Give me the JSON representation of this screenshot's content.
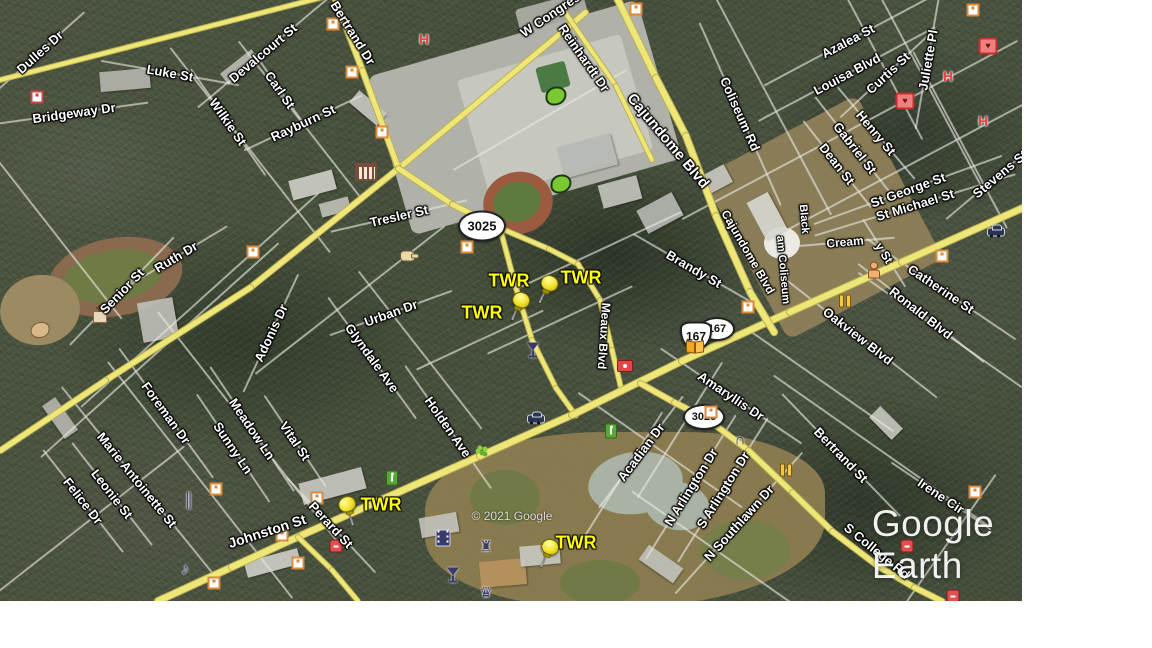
{
  "app": {
    "watermark": "Google Earth",
    "copyright": "© 2021 Google",
    "watermark_pos": {
      "x": 933,
      "y": 545
    },
    "copyright_pos": {
      "x": 512,
      "y": 516
    }
  },
  "map": {
    "colors": {
      "road_major": "#efe678",
      "road_major_edge": "#b9b055",
      "road_minor": "rgba(232,232,224,0.62)",
      "street_label": "#ffffff",
      "pin_yellow": "#f2e02e",
      "twr_label": "#ffff00",
      "shield_bg": "#ffffff"
    },
    "placemark_labels": [
      {
        "text": "TWR",
        "x": 509,
        "y": 281
      },
      {
        "text": "TWR",
        "x": 581,
        "y": 278
      },
      {
        "text": "TWR",
        "x": 482,
        "y": 313
      },
      {
        "text": "TWR",
        "x": 381,
        "y": 505
      },
      {
        "text": "TWR",
        "x": 576,
        "y": 543
      }
    ],
    "pins": [
      {
        "x": 545,
        "y": 284,
        "rot": 25
      },
      {
        "x": 517,
        "y": 301,
        "rot": 22
      },
      {
        "x": 349,
        "y": 506,
        "rot": -18
      },
      {
        "x": 546,
        "y": 548,
        "rot": 22
      }
    ],
    "route_shields": [
      {
        "style": "oval",
        "label": "3025",
        "x": 482,
        "y": 226,
        "w": 44,
        "h": 27,
        "fs": 13
      },
      {
        "style": "oval",
        "label": "3025",
        "x": 704,
        "y": 417,
        "w": 38,
        "h": 22,
        "fs": 11
      },
      {
        "style": "oval",
        "label": "167",
        "x": 717,
        "y": 329,
        "w": 32,
        "h": 20,
        "fs": 11
      },
      {
        "style": "us",
        "label": "167",
        "x": 696,
        "y": 336,
        "w": 28,
        "h": 25,
        "fs": 12
      }
    ],
    "streets": [
      [
        "Dulles Dr",
        40,
        52,
        -42,
        13,
        120
      ],
      [
        "Luke St",
        170,
        73,
        10,
        13,
        140
      ],
      [
        "Devalcourt St",
        263,
        53,
        -40,
        13,
        170
      ],
      [
        "Bridgeway Dr",
        74,
        113,
        -8,
        13,
        150
      ],
      [
        "Wilkie St",
        228,
        122,
        55,
        13,
        130
      ],
      [
        "Carl St",
        280,
        90,
        55,
        13,
        90
      ],
      [
        "Rayburn St",
        303,
        123,
        -25,
        13,
        130
      ],
      [
        "Bertrand Dr",
        353,
        33,
        58,
        13,
        0
      ],
      [
        "W Congress St",
        560,
        8,
        -34,
        13,
        0
      ],
      [
        "Reinhardt Dr",
        584,
        58,
        55,
        13,
        0
      ],
      [
        "Cajundome Blvd",
        668,
        141,
        50,
        15,
        0
      ],
      [
        "Cajundome Blvd",
        748,
        252,
        60,
        12,
        0
      ],
      [
        "Coliseum Rd",
        740,
        114,
        66,
        13,
        200
      ],
      [
        "Azalea St",
        848,
        41,
        -28,
        13,
        190
      ],
      [
        "Louisa Blvd",
        847,
        74,
        -28,
        13,
        200
      ],
      [
        "Curtis St",
        888,
        73,
        -43,
        13,
        130
      ],
      [
        "Juliette Pl",
        928,
        60,
        -80,
        13,
        140
      ],
      [
        "Henry St",
        876,
        133,
        50,
        13,
        120
      ],
      [
        "Gabriel St",
        855,
        148,
        52,
        13,
        130
      ],
      [
        "Dean St",
        837,
        164,
        52,
        13,
        110
      ],
      [
        "St George St",
        908,
        190,
        -20,
        13,
        200
      ],
      [
        "Stevens St",
        1000,
        174,
        -40,
        13,
        140
      ],
      [
        "St Michael St",
        915,
        205,
        -17,
        13,
        210
      ],
      [
        "Black",
        804,
        219,
        85,
        11,
        0
      ],
      [
        "am Coliseum",
        783,
        270,
        85,
        11,
        0
      ],
      [
        "Cream",
        845,
        242,
        -5,
        12,
        100
      ],
      [
        "y St",
        884,
        253,
        58,
        12,
        80
      ],
      [
        "Catherine St",
        941,
        289,
        34,
        13,
        180
      ],
      [
        "Ronald Blvd",
        921,
        313,
        38,
        13,
        160
      ],
      [
        "Oakview Blvd",
        858,
        336,
        38,
        13,
        200
      ],
      [
        "Brandy St",
        694,
        269,
        30,
        13,
        140
      ],
      [
        "Meaux Blvd",
        604,
        336,
        94,
        12,
        0
      ],
      [
        "Tresler St",
        399,
        216,
        -13,
        13,
        140
      ],
      [
        "Senior St",
        122,
        291,
        -46,
        13,
        150
      ],
      [
        "Ruth Dr",
        176,
        257,
        -31,
        13,
        120
      ],
      [
        "Adonis Dr",
        271,
        333,
        -65,
        13,
        130
      ],
      [
        "Urban Dr",
        391,
        313,
        -20,
        13,
        130
      ],
      [
        "Glyndale Ave",
        372,
        358,
        54,
        13,
        150
      ],
      [
        "Holden Ave",
        448,
        427,
        55,
        13,
        150
      ],
      [
        "Meadow Ln",
        252,
        429,
        56,
        13,
        150
      ],
      [
        "Sunny Ln",
        233,
        448,
        56,
        13,
        130
      ],
      [
        "Vital St",
        295,
        441,
        56,
        13,
        110
      ],
      [
        "Foreman Dr",
        166,
        413,
        54,
        13,
        160
      ],
      [
        "Marie Antoinette St",
        137,
        480,
        51,
        13,
        240
      ],
      [
        "Leonie St",
        112,
        494,
        52,
        13,
        130
      ],
      [
        "Felice Dr",
        83,
        501,
        52,
        13,
        130
      ],
      [
        "Johnston St",
        267,
        531,
        -18,
        14,
        0
      ],
      [
        "Perard St",
        331,
        525,
        47,
        13,
        130
      ],
      [
        "Amaryllis Dr",
        731,
        396,
        34,
        13,
        170
      ],
      [
        "Acadian Dr",
        641,
        452,
        -53,
        13,
        140
      ],
      [
        "N Arlington Dr",
        691,
        487,
        -58,
        13,
        170
      ],
      [
        "S Arlington Dr",
        723,
        490,
        -58,
        13,
        170
      ],
      [
        "N Southlawn Dr",
        739,
        523,
        -48,
        13,
        190
      ],
      [
        "Bertrand St",
        841,
        455,
        46,
        13,
        170
      ],
      [
        "Irene Cir",
        941,
        496,
        34,
        13,
        120
      ],
      [
        "S College Rd",
        877,
        551,
        39,
        13,
        0
      ]
    ],
    "roads": [
      {
        "name": "dulles-dr",
        "width": 6,
        "points": [
          [
            0,
            80
          ],
          [
            335,
            -6
          ]
        ]
      },
      {
        "name": "w-congress-st",
        "width": 7,
        "points": [
          [
            585,
            12
          ],
          [
            398,
            168
          ],
          [
            250,
            287
          ],
          [
            105,
            380
          ],
          [
            0,
            450
          ]
        ]
      },
      {
        "name": "bertrand-dr",
        "width": 7,
        "points": [
          [
            333,
            -6
          ],
          [
            362,
            70
          ],
          [
            398,
            168
          ],
          [
            452,
            204
          ],
          [
            500,
            228
          ]
        ]
      },
      {
        "name": "la-3025",
        "width": 6,
        "points": [
          [
            500,
            228
          ],
          [
            516,
            288
          ],
          [
            532,
            340
          ],
          [
            556,
            388
          ],
          [
            576,
            416
          ]
        ]
      },
      {
        "name": "meaux-blvd",
        "width": 6,
        "points": [
          [
            500,
            228
          ],
          [
            549,
            249
          ],
          [
            578,
            264
          ],
          [
            600,
            300
          ],
          [
            612,
            350
          ],
          [
            622,
            392
          ]
        ]
      },
      {
        "name": "johnston-st",
        "width": 8,
        "points": [
          [
            158,
            601
          ],
          [
            232,
            567
          ],
          [
            302,
            535
          ],
          [
            480,
            456
          ],
          [
            572,
            415
          ],
          [
            682,
            361
          ],
          [
            790,
            312
          ],
          [
            902,
            262
          ],
          [
            1025,
            207
          ]
        ]
      },
      {
        "name": "johnston-branch",
        "width": 6,
        "points": [
          [
            298,
            537
          ],
          [
            332,
            570
          ],
          [
            358,
            601
          ]
        ]
      },
      {
        "name": "reinhardt-dr",
        "width": 6,
        "points": [
          [
            562,
            8
          ],
          [
            616,
            86
          ],
          [
            652,
            160
          ]
        ]
      },
      {
        "name": "cajundome-blvd",
        "width": 8,
        "points": [
          [
            616,
            -4
          ],
          [
            656,
            78
          ],
          [
            686,
            136
          ],
          [
            716,
            216
          ],
          [
            750,
            292
          ],
          [
            774,
            332
          ]
        ]
      },
      {
        "name": "s-college-rd",
        "width": 7,
        "points": [
          [
            640,
            383
          ],
          [
            674,
            402
          ],
          [
            706,
            418
          ],
          [
            748,
            450
          ],
          [
            792,
            492
          ],
          [
            832,
            531
          ],
          [
            878,
            566
          ],
          [
            914,
            587
          ],
          [
            942,
            601
          ]
        ]
      }
    ],
    "minor_segments": [
      [
        250,
        150,
        52,
        260
      ],
      [
        300,
        120,
        52,
        200
      ],
      [
        200,
        300,
        -42,
        320
      ],
      [
        160,
        350,
        -42,
        320
      ],
      [
        250,
        430,
        52,
        300
      ],
      [
        200,
        480,
        52,
        300
      ],
      [
        540,
        120,
        -30,
        200
      ],
      [
        850,
        130,
        -28,
        380
      ],
      [
        900,
        170,
        -28,
        300
      ],
      [
        930,
        90,
        62,
        220
      ],
      [
        880,
        60,
        62,
        180
      ],
      [
        960,
        140,
        62,
        200
      ],
      [
        770,
        100,
        62,
        260
      ],
      [
        600,
        250,
        -25,
        180
      ],
      [
        560,
        320,
        -25,
        160
      ],
      [
        660,
        450,
        35,
        200
      ],
      [
        730,
        560,
        35,
        240
      ],
      [
        880,
        450,
        35,
        260
      ],
      [
        950,
        540,
        -55,
        160
      ],
      [
        420,
        350,
        52,
        200
      ],
      [
        350,
        300,
        -38,
        240
      ],
      [
        90,
        520,
        -38,
        240
      ],
      [
        60,
        240,
        52,
        200
      ],
      [
        940,
        330,
        35,
        200
      ],
      [
        620,
        480,
        -58,
        160
      ],
      [
        680,
        430,
        -58,
        160
      ],
      [
        480,
        340,
        -25,
        140
      ],
      [
        820,
        380,
        35,
        180
      ]
    ],
    "poi_icons": [
      [
        "hospital-h",
        424,
        39
      ],
      [
        "hospital-h",
        948,
        76
      ],
      [
        "hospital-h",
        983,
        121
      ],
      [
        "first-aid",
        988,
        46
      ],
      [
        "first-aid",
        905,
        101
      ],
      [
        "square-red",
        37,
        97
      ],
      [
        "square-orange",
        333,
        24
      ],
      [
        "square-orange",
        352,
        72
      ],
      [
        "square-orange",
        382,
        132
      ],
      [
        "square-orange",
        973,
        10
      ],
      [
        "square-orange",
        636,
        9
      ],
      [
        "square-orange",
        253,
        252
      ],
      [
        "square-orange",
        467,
        247
      ],
      [
        "square-orange",
        942,
        256
      ],
      [
        "square-orange",
        748,
        307
      ],
      [
        "square-orange",
        711,
        412
      ],
      [
        "square-orange",
        975,
        492
      ],
      [
        "square-orange",
        216,
        489
      ],
      [
        "square-orange",
        282,
        535
      ],
      [
        "square-orange",
        298,
        563
      ],
      [
        "square-orange",
        214,
        583
      ],
      [
        "square-orange",
        317,
        498
      ],
      [
        "museum",
        366,
        172
      ],
      [
        "church",
        100,
        317
      ],
      [
        "pointing-hand",
        408,
        256
      ],
      [
        "person",
        874,
        270
      ],
      [
        "blob-tan",
        40,
        330
      ],
      [
        "blob-green",
        556,
        96
      ],
      [
        "blob-green",
        561,
        184
      ],
      [
        "ped-green",
        611,
        431
      ],
      [
        "ped-green",
        392,
        478
      ],
      [
        "flower-green",
        480,
        448
      ],
      [
        "restaurant",
        845,
        301
      ],
      [
        "restaurant",
        786,
        470
      ],
      [
        "open-book",
        695,
        347
      ],
      [
        "camera-red",
        625,
        366
      ],
      [
        "red-poi",
        336,
        546
      ],
      [
        "red-poi",
        907,
        546
      ],
      [
        "red-poi",
        953,
        596
      ],
      [
        "car",
        996,
        232
      ],
      [
        "car",
        536,
        419
      ],
      [
        "music",
        185,
        570
      ],
      [
        "double-bar",
        189,
        500
      ],
      [
        "martini",
        453,
        575
      ],
      [
        "martini",
        533,
        350
      ],
      [
        "film",
        443,
        538
      ],
      [
        "castle",
        486,
        546
      ],
      [
        "masks",
        486,
        592
      ],
      [
        "arch",
        740,
        440
      ]
    ]
  }
}
